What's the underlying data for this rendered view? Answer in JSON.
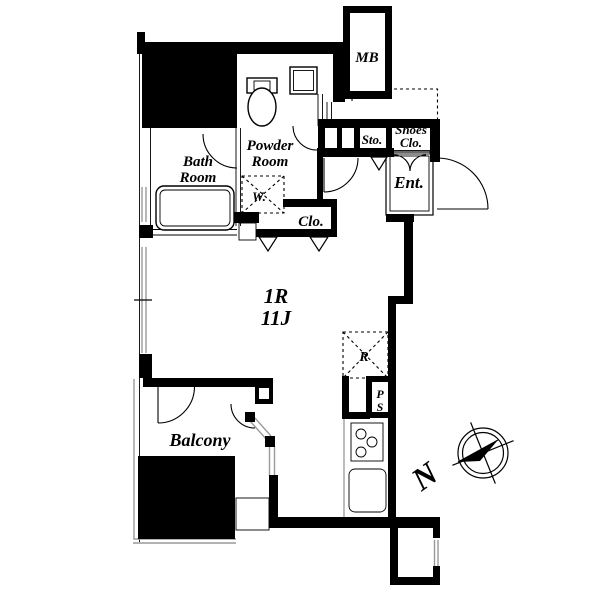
{
  "plan": {
    "unit": {
      "type": "1R",
      "size": "11J"
    },
    "rooms": {
      "meter_box": "MB",
      "powder_line1": "Powder",
      "powder_line2": "Room",
      "bath_line1": "Bath",
      "bath_line2": "Room",
      "storage": "Sto.",
      "shoes_line1": "Shoes",
      "shoes_line2": "Clo.",
      "entrance": "Ent.",
      "closet": "Clo.",
      "washer": "W.",
      "refrigerator": "R",
      "pipe_line1": "P",
      "pipe_line2": "S",
      "balcony": "Balcony"
    },
    "compass": {
      "north": "N"
    },
    "colors": {
      "wall": "#000000",
      "background": "#ffffff",
      "glazing": "#999999"
    },
    "fixtures": [
      "toilet",
      "washbasin",
      "bathtub",
      "gas-stove",
      "kitchen-sink"
    ]
  }
}
